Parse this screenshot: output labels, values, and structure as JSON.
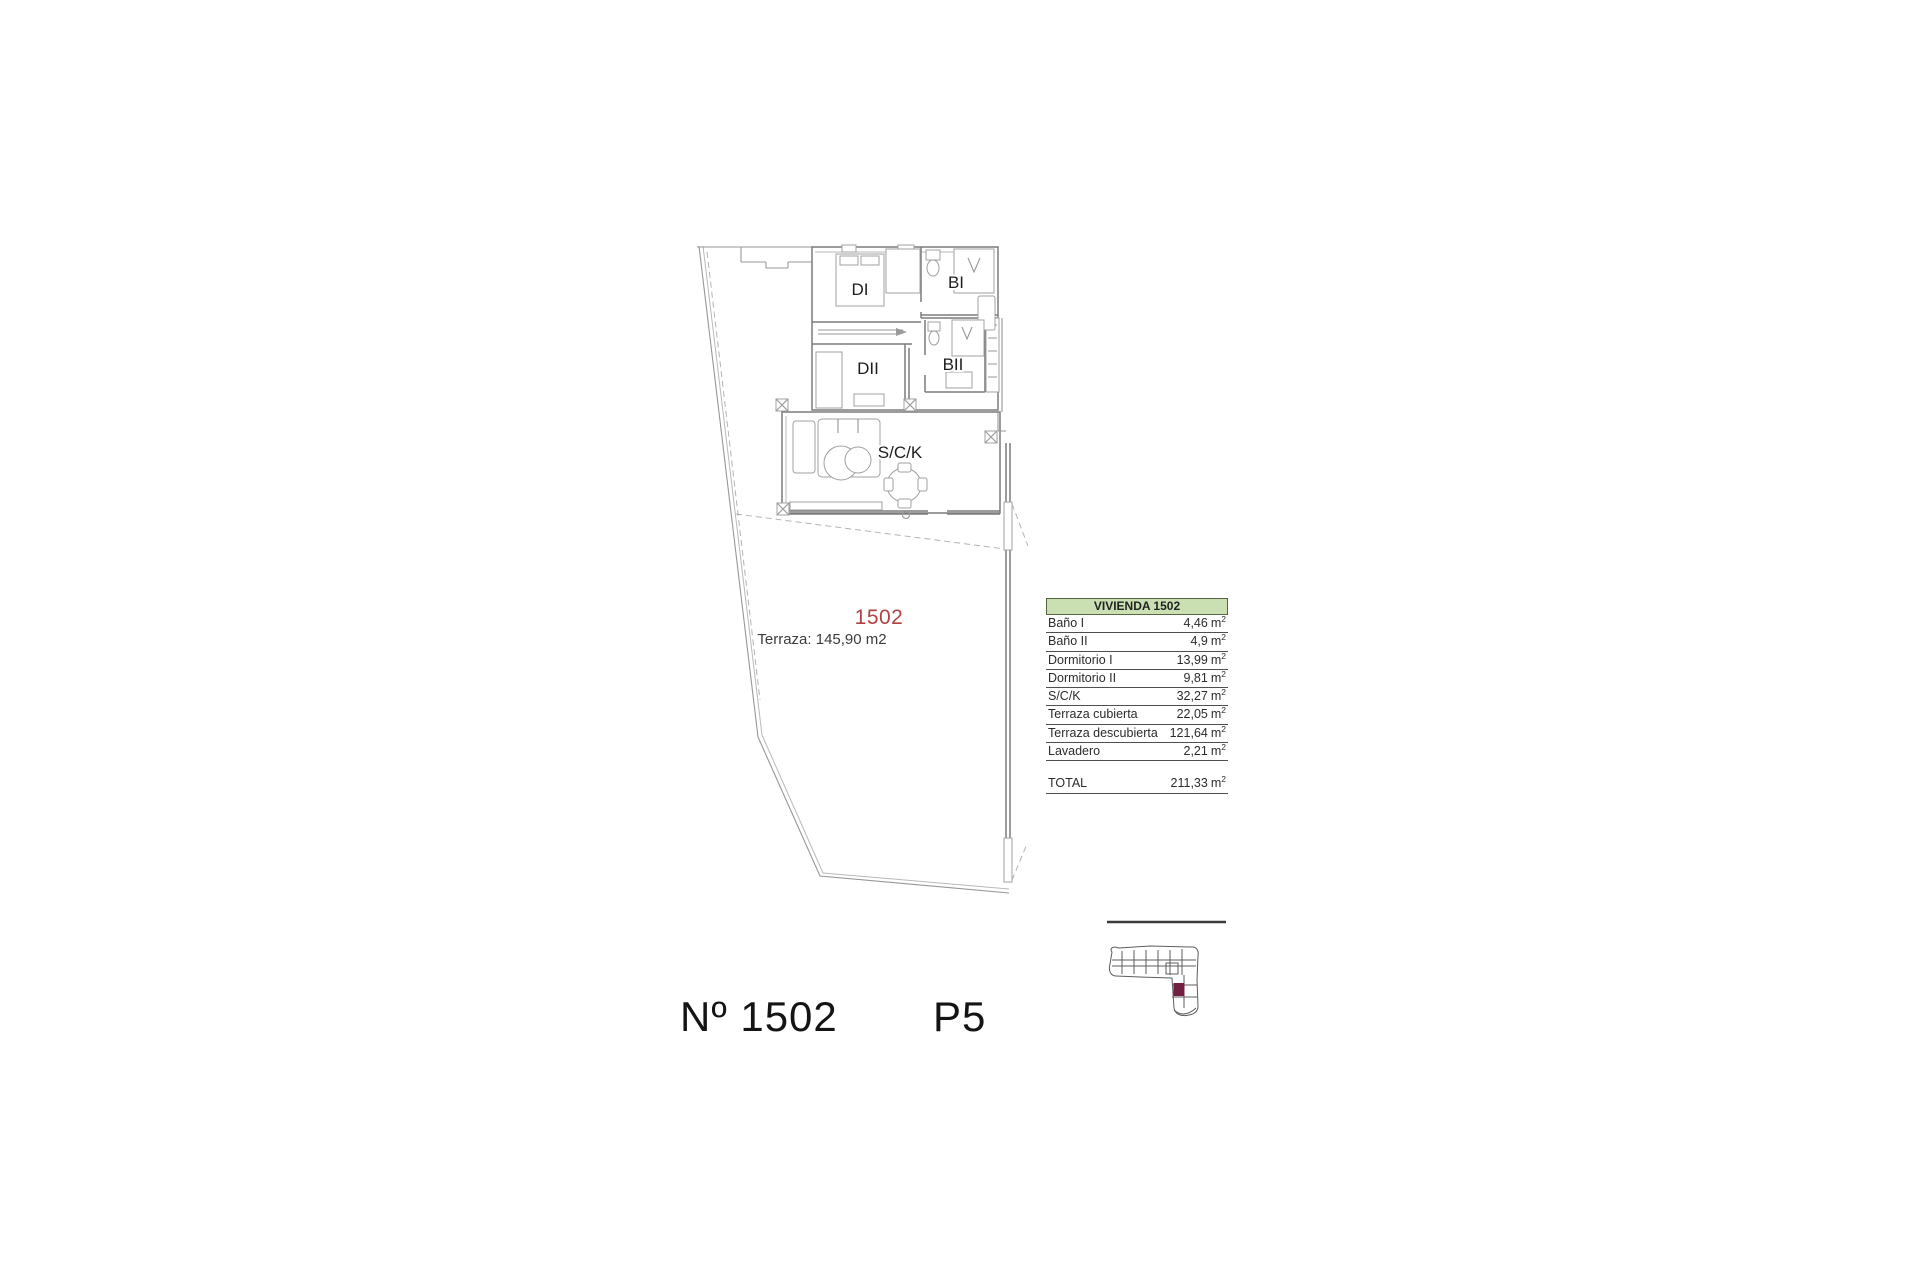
{
  "colors": {
    "unit_red": "#b04343",
    "table_header_green": "#cadfb2",
    "keyplan_highlight": "#731f42",
    "plan_line_gray": "#979797"
  },
  "plan": {
    "room_labels": {
      "d1": "DI",
      "b1": "BI",
      "d2": "DII",
      "b2": "BII",
      "sck": "S/C/K"
    },
    "unit_number": "1502",
    "terrace_note": "Terraza: 145,90 m2"
  },
  "area_table": {
    "title": "VIVIENDA 1502",
    "unit": "m",
    "unit_exponent": "2",
    "rows": [
      {
        "label": "Baño I",
        "value": "4,46"
      },
      {
        "label": "Baño II",
        "value": "4,9"
      },
      {
        "label": "Dormitorio I",
        "value": "13,99"
      },
      {
        "label": "Dormitorio II",
        "value": "9,81"
      },
      {
        "label": "S/C/K",
        "value": "32,27"
      },
      {
        "label": "Terraza cubierta",
        "value": "22,05"
      },
      {
        "label": "Terraza descubierta",
        "value": "121,64"
      },
      {
        "label": "Lavadero",
        "value": "2,21"
      }
    ],
    "total": {
      "label": "TOTAL",
      "value": "211,33"
    }
  },
  "footer": {
    "unit_label": "Nº 1502",
    "floor_label": "P5"
  }
}
